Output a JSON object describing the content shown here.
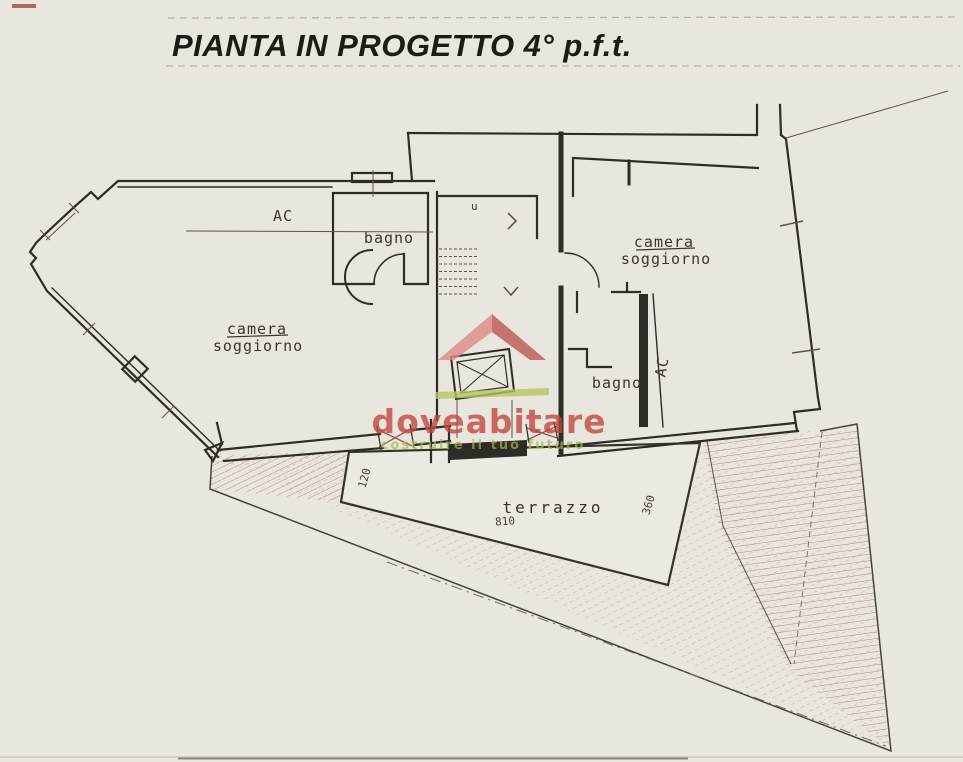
{
  "title": {
    "text": "PIANTA IN PROGETTO 4° p.f.t."
  },
  "labels": {
    "ac_left": "AC",
    "bagno_left": "bagno",
    "camera_left": {
      "line1": "camera",
      "line2": "soggiorno"
    },
    "camera_right": {
      "line1": "camera",
      "line2": "soggiorno"
    },
    "bagno_right": "bagno",
    "ac_right": "AC",
    "stair_note": "u",
    "terrazzo": "terrazzo"
  },
  "dimensions": {
    "terrace_left": "120",
    "terrace_bottom": "810",
    "terrace_right": "360"
  },
  "watermark": {
    "brand": "doveabitare",
    "tagline": "costruire il tuo futuro",
    "brand_color": "#c2453c",
    "tagline_color": "#a3b94b",
    "roof_light": "#dd8a85",
    "roof_dark": "#b95852",
    "bar_color": "#b3c75f"
  },
  "colors": {
    "paper": "#e9e6df",
    "terrace_paper": "#ece9e2",
    "ink": "#2f2b27",
    "thin_ink": "#5b554d",
    "hatch_red": "#b08a80",
    "hatch_faint": "#c9aca1",
    "window_tick": "#9a5a48",
    "scan_rule": "#b9b4ab"
  }
}
